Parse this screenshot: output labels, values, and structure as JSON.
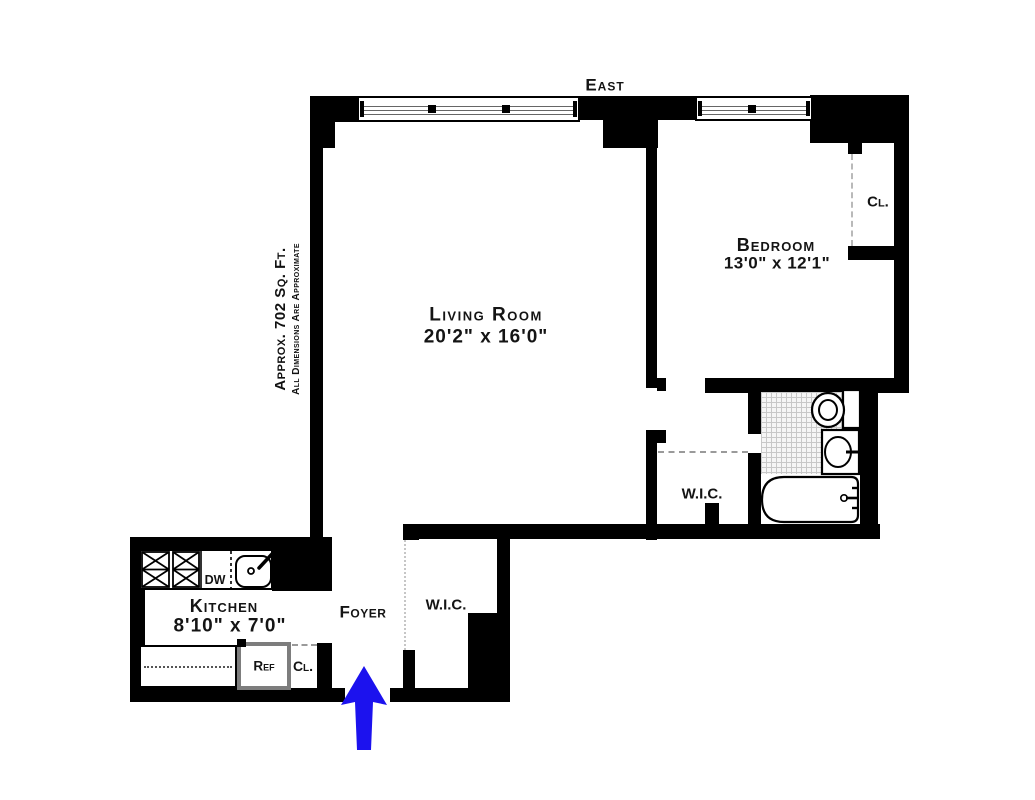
{
  "plan": {
    "compass_label": "East",
    "area_note": {
      "line1": "Approx. 702 Sq. Ft.",
      "line2": "All Dimensions Are Approximate"
    },
    "rooms": {
      "living_room": {
        "name": "Living Room",
        "dims": "20'2\" x 16'0\""
      },
      "bedroom": {
        "name": "Bedroom",
        "dims": "13'0\" x 12'1\""
      },
      "kitchen": {
        "name": "Kitchen",
        "dims": "8'10\" x 7'0\""
      },
      "foyer": {
        "name": "Foyer"
      },
      "walk_in_closet_hall": {
        "name": "W.I.C."
      },
      "walk_in_closet_foyer": {
        "name": "W.I.C."
      },
      "bedroom_closet": {
        "name": "Cl."
      },
      "kitchen_closet": {
        "name": "Cl."
      }
    },
    "appliances": {
      "dishwasher": "DW",
      "refrigerator": "Ref"
    },
    "colors": {
      "wall": "#000000",
      "entry_arrow": "#1c12ee",
      "tile_line": "#c8c8c8",
      "door_dash": "#bbbbbb"
    }
  }
}
